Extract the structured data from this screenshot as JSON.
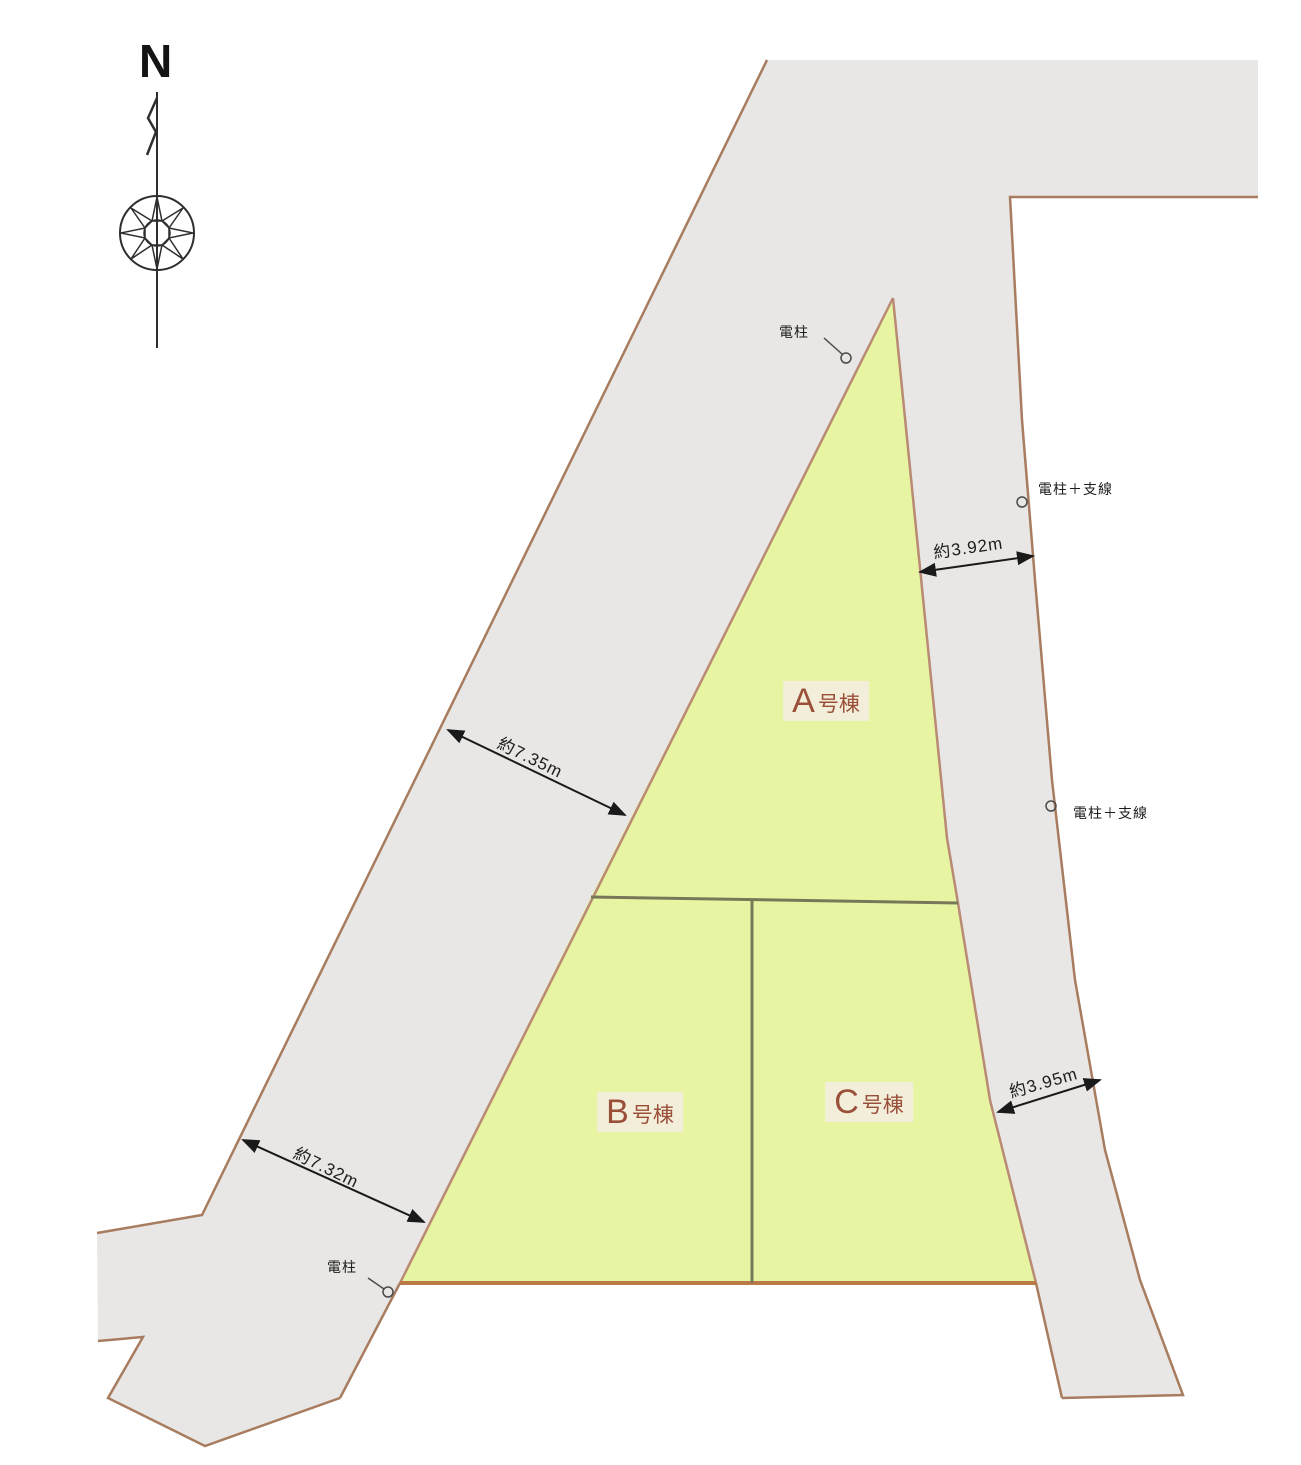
{
  "compass": {
    "north_label": "N"
  },
  "lots": [
    {
      "letter": "A",
      "suffix": "号棟"
    },
    {
      "letter": "B",
      "suffix": "号棟"
    },
    {
      "letter": "C",
      "suffix": "号棟"
    }
  ],
  "dimensions": {
    "left_road_upper": "約7.35m",
    "left_road_lower": "約7.32m",
    "right_road_upper": "約3.92m",
    "right_road_lower": "約3.95m"
  },
  "annotations": {
    "pole_top": "電柱",
    "pole_right_upper": "電柱＋支線",
    "pole_right_lower": "電柱＋支線",
    "pole_bottom": "電柱"
  },
  "colors": {
    "road_fill": "#e8e7e5",
    "road_border": "#a87c5f",
    "lot_fill": "#e7f5a2",
    "lot_border": "#b98a74",
    "lot_bottom_border": "#b97a45",
    "division_line": "#77775a",
    "dimension_color": "#1a1a1a",
    "pole_color": "#4a4a4a",
    "compass_color": "#2e2e2e",
    "lot_label_text": "#9a4f38",
    "lot_label_bg": "#f3eeda"
  }
}
